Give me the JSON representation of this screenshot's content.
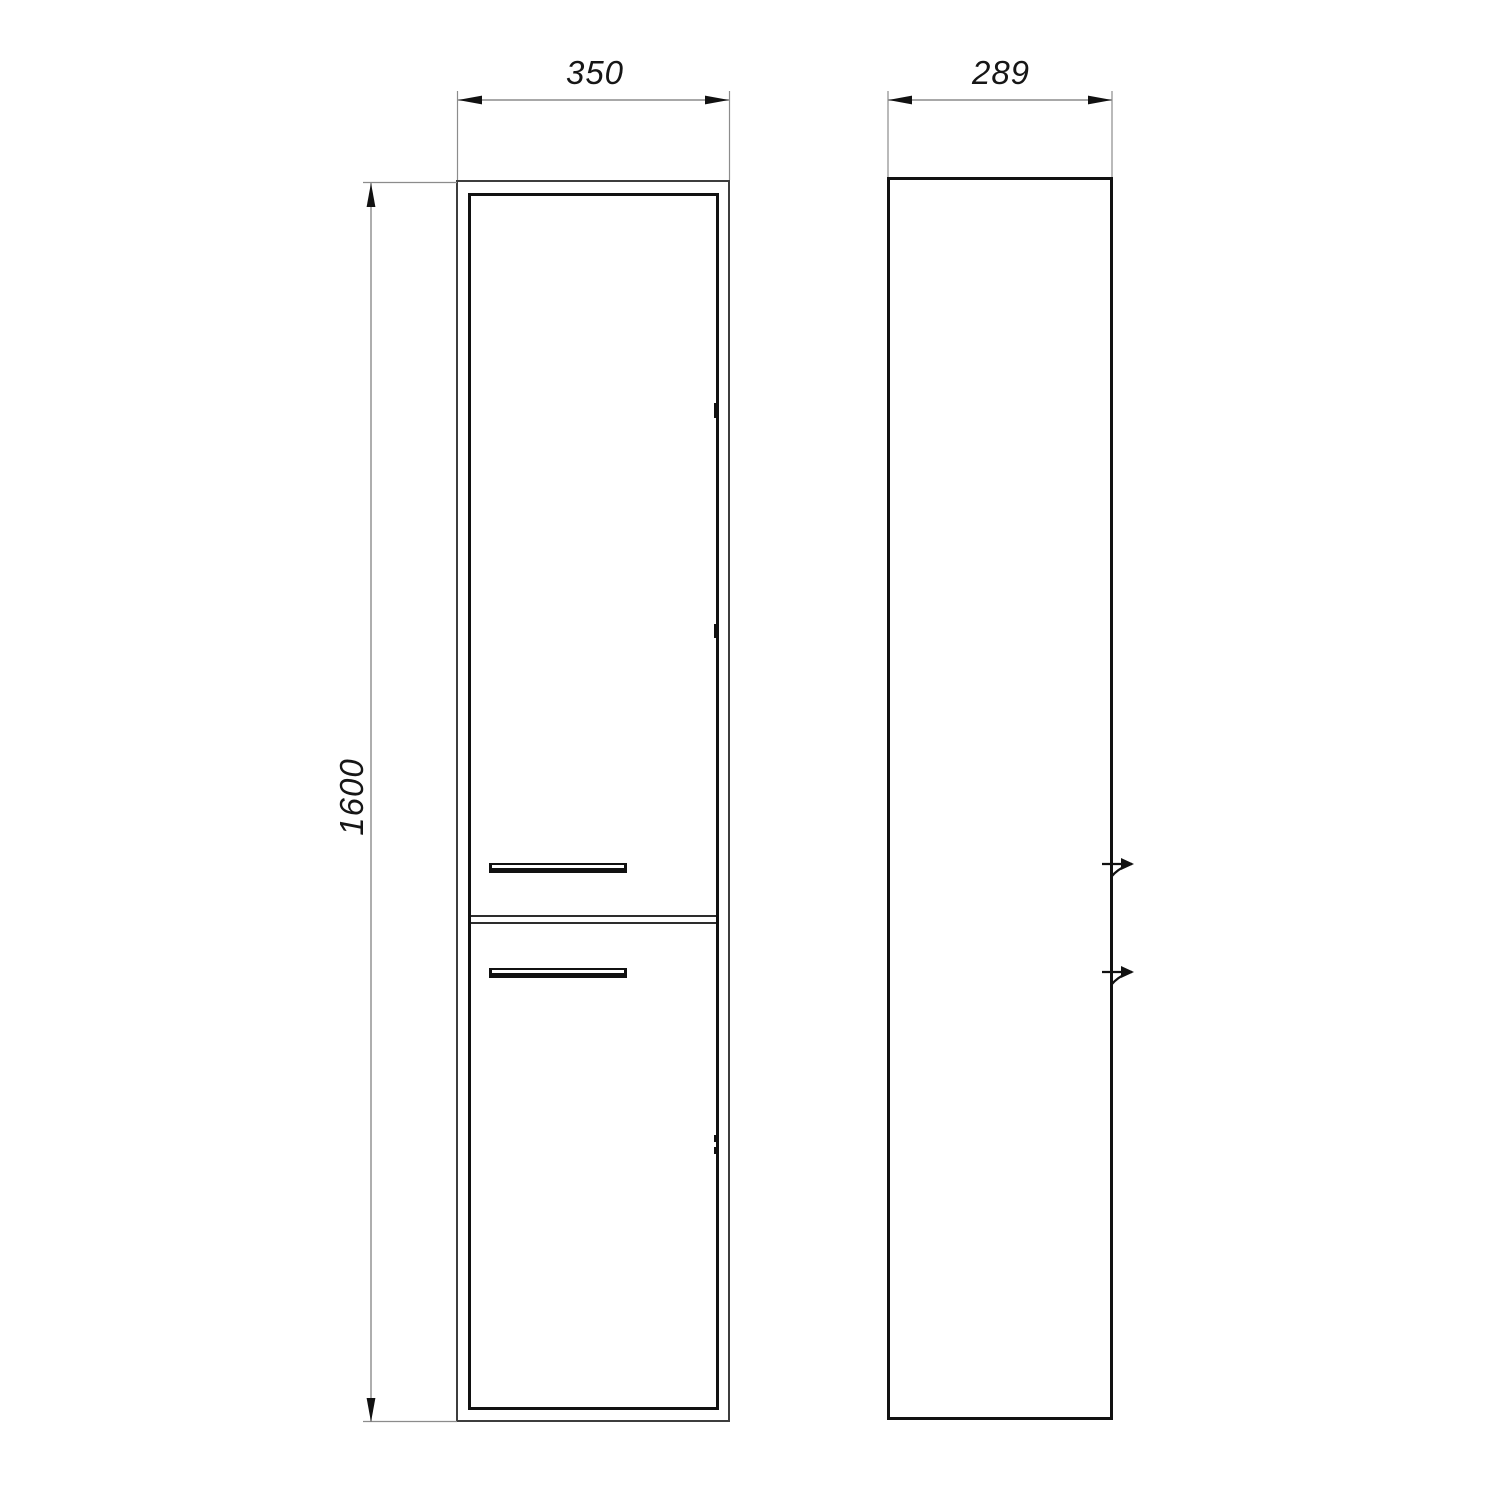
{
  "dimensions": {
    "width": "350",
    "depth": "289",
    "height": "1600"
  },
  "icons": {
    "wall_bracket": "wall-bracket-icon"
  },
  "colors": {
    "bg": "#ffffff",
    "outline": "#3d3d3d",
    "edge": "#111111",
    "dim": "#8c8c8c",
    "text": "#161616"
  }
}
